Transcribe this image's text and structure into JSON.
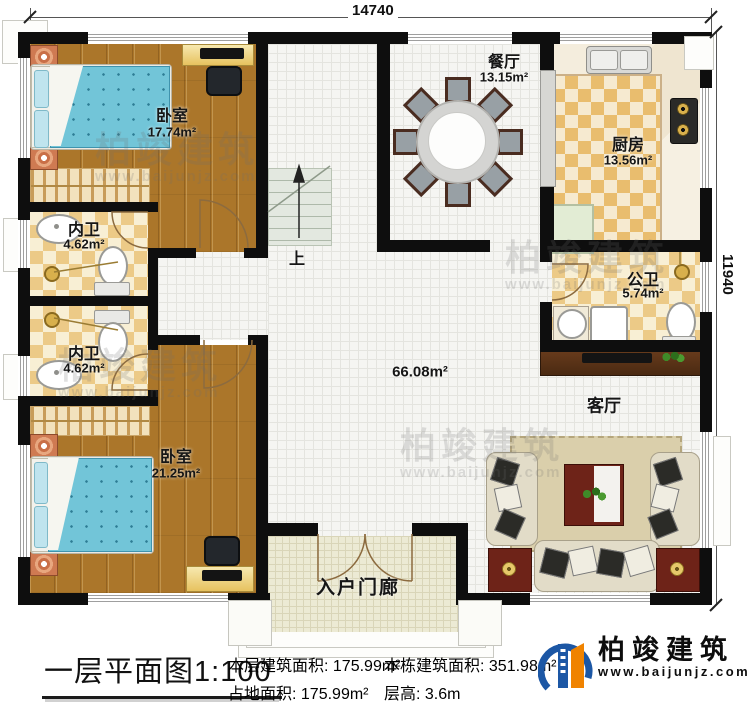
{
  "dimensions": {
    "width": "14740",
    "height": "11940"
  },
  "rooms": {
    "bedroom1": {
      "label": "卧室",
      "area": "17.74m²"
    },
    "bedroom2": {
      "label": "卧室",
      "area": "21.25m²"
    },
    "bath1": {
      "label": "内卫",
      "area": "4.62m²"
    },
    "bath2": {
      "label": "内卫",
      "area": "4.62m²"
    },
    "dining": {
      "label": "餐厅",
      "area": "13.15m²"
    },
    "kitchen": {
      "label": "厨房",
      "area": "13.56m²"
    },
    "public_bath": {
      "label": "公卫",
      "area": "5.74m²"
    },
    "living": {
      "label": "客厅"
    },
    "hall": {
      "area": "66.08m²"
    },
    "porch": {
      "label": "入户门廊"
    },
    "stairs": {
      "label": "上"
    }
  },
  "title_block": {
    "title": "一层平面图",
    "scale": "1:100",
    "floor_area_label": "本层建筑面积:",
    "floor_area": "175.99m²",
    "footprint_label": "占地面积:",
    "footprint": "175.99m²",
    "total_area_label": "本栋建筑面积:",
    "total_area": "351.98m²",
    "height_label": "层高:",
    "height": "3.6m"
  },
  "logo": {
    "name": "柏竣建筑",
    "url": "www.baijunjz.com"
  },
  "watermark": {
    "name": "柏竣建筑",
    "url": "www.baijunjz.com"
  },
  "colors": {
    "wall": "#0e0e0e",
    "wood": "#ab762a",
    "checker": "#ecca87",
    "logo_blue": "#1c57a5",
    "logo_orange": "#f08300"
  }
}
